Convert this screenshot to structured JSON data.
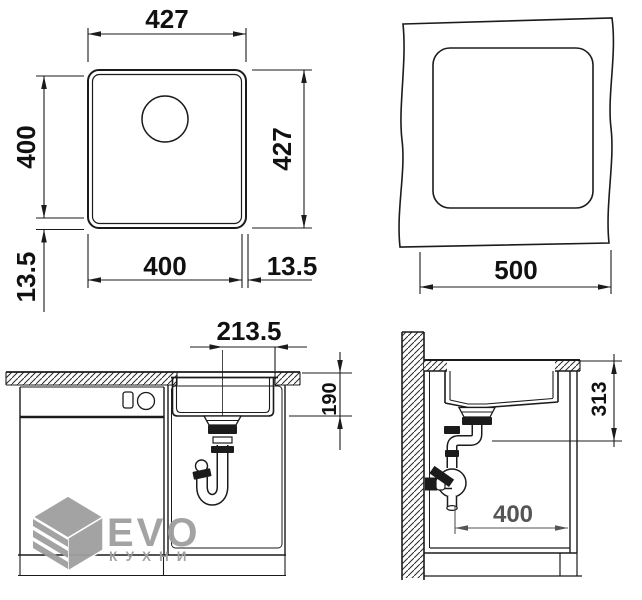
{
  "views": {
    "top_plan": {
      "dim_top": "427",
      "dim_right": "427",
      "dim_left_bowl": "400",
      "dim_left_rim": "13.5",
      "dim_bottom_bowl": "400",
      "dim_bottom_rim": "13.5"
    },
    "cutout_plan": {
      "dim_width": "500"
    },
    "front_section": {
      "dim_center_to_edge": "213.5",
      "dim_bowl_depth": "190"
    },
    "side_section": {
      "dim_install_depth": "313",
      "dim_cabinet_depth": "400"
    }
  },
  "watermark": {
    "brand": "EVO",
    "brand_sub": "КУХНИ"
  },
  "colors": {
    "line": "#1b1b1b",
    "dim_text": "#111111",
    "secondary_dim": "#555555",
    "watermark_gray": "#9f9f9f",
    "background": "#ffffff"
  }
}
